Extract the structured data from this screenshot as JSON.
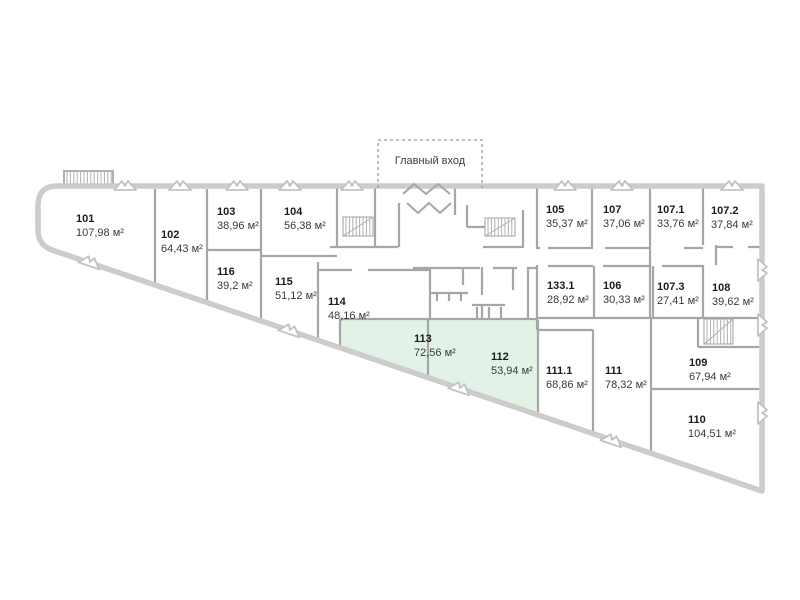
{
  "plan_title": "floor-plan",
  "entrance": {
    "label": "Главный вход"
  },
  "area_unit": "м²",
  "colors": {
    "highlight_fill": "#e2f2e6",
    "wall_exterior": "#cccccc",
    "wall_interior": "#a6a6a6",
    "text_primary": "#1c1c1c",
    "text_secondary": "#3a3a3a"
  },
  "rooms": [
    {
      "number": "101",
      "area": "107,98 м²",
      "highlighted": false,
      "label": [
        76,
        222
      ],
      "points": "42,190 155,190 155,284 52,249 40,240 40,205"
    },
    {
      "number": "102",
      "area": "64,43 м²",
      "highlighted": false,
      "label": [
        161,
        238
      ],
      "points": "155,190 207,190 207,302 155,284"
    },
    {
      "number": "103",
      "area": "38,96 м²",
      "highlighted": false,
      "label": [
        217,
        215
      ],
      "points": "207,190 261,190 261,250 207,250"
    },
    {
      "number": "104",
      "area": "56,38 м²",
      "highlighted": false,
      "label": [
        284,
        215
      ],
      "points": "261,190 337,190 337,256 261,256"
    },
    {
      "number": "116",
      "area": "39,2 м²",
      "highlighted": false,
      "label": [
        217,
        275
      ],
      "points": "207,250 261,250 261,321 207,302"
    },
    {
      "number": "115",
      "area": "51,12 м²",
      "highlighted": false,
      "label": [
        275,
        285
      ],
      "points": "261,256 318,256 318,340 261,321"
    },
    {
      "number": "114",
      "area": "48,16 м²",
      "highlighted": false,
      "label": [
        328,
        305
      ],
      "points": "318,270 430,270 430,319 340,319 340,347 318,340"
    },
    {
      "number": "113",
      "area": "72,56 м²",
      "highlighted": true,
      "label": [
        414,
        342
      ],
      "points": "340,320 428,320 428,377 340,347"
    },
    {
      "number": "112",
      "area": "53,94 м²",
      "highlighted": true,
      "label": [
        491,
        360
      ],
      "points": "428,320 538,320 538,415 428,377"
    },
    {
      "number": "105",
      "area": "35,37 м²",
      "highlighted": false,
      "label": [
        546,
        213
      ],
      "points": "537,189 592,189 592,247 537,247"
    },
    {
      "number": "107",
      "area": "37,06 м²",
      "highlighted": false,
      "label": [
        603,
        213
      ],
      "points": "592,189 650,189 650,247 592,247"
    },
    {
      "number": "107.1",
      "area": "33,76 м²",
      "highlighted": false,
      "label": [
        657,
        213
      ],
      "points": "650,189 703,189 703,247 650,247"
    },
    {
      "number": "107.2",
      "area": "37,84 м²",
      "highlighted": false,
      "label": [
        711,
        214
      ],
      "points": "703,189 762,189 762,245 703,245"
    },
    {
      "number": "133.1",
      "area": "28,92 м²",
      "highlighted": false,
      "label": [
        547,
        289
      ],
      "points": "538,266 594,266 594,318 538,318"
    },
    {
      "number": "106",
      "area": "30,33 м²",
      "highlighted": false,
      "label": [
        603,
        289
      ],
      "points": "594,266 653,266 653,318 594,318"
    },
    {
      "number": "107.3",
      "area": "27,41 м²",
      "highlighted": false,
      "label": [
        657,
        290
      ],
      "points": "653,266 703,266 703,318 653,318"
    },
    {
      "number": "108",
      "area": "39,62 м²",
      "highlighted": false,
      "label": [
        712,
        291
      ],
      "points": "716,247 762,247 762,318 703,318 703,265 716,265"
    },
    {
      "number": "111.1",
      "area": "68,86 м²",
      "highlighted": false,
      "label": [
        546,
        374
      ],
      "points": "538,330 593,330 593,433 538,415"
    },
    {
      "number": "111",
      "area": "78,32 м²",
      "highlighted": false,
      "label": [
        605,
        374
      ],
      "points": "593,318 651,318 651,453 593,433"
    },
    {
      "number": "109",
      "area": "67,94 м²",
      "highlighted": false,
      "label": [
        689,
        366
      ],
      "points": "651,318 762,318 762,389 651,389"
    },
    {
      "number": "110",
      "area": "104,51 м²",
      "highlighted": false,
      "label": [
        688,
        423
      ],
      "points": "651,389 762,389 762,491 651,453"
    }
  ]
}
